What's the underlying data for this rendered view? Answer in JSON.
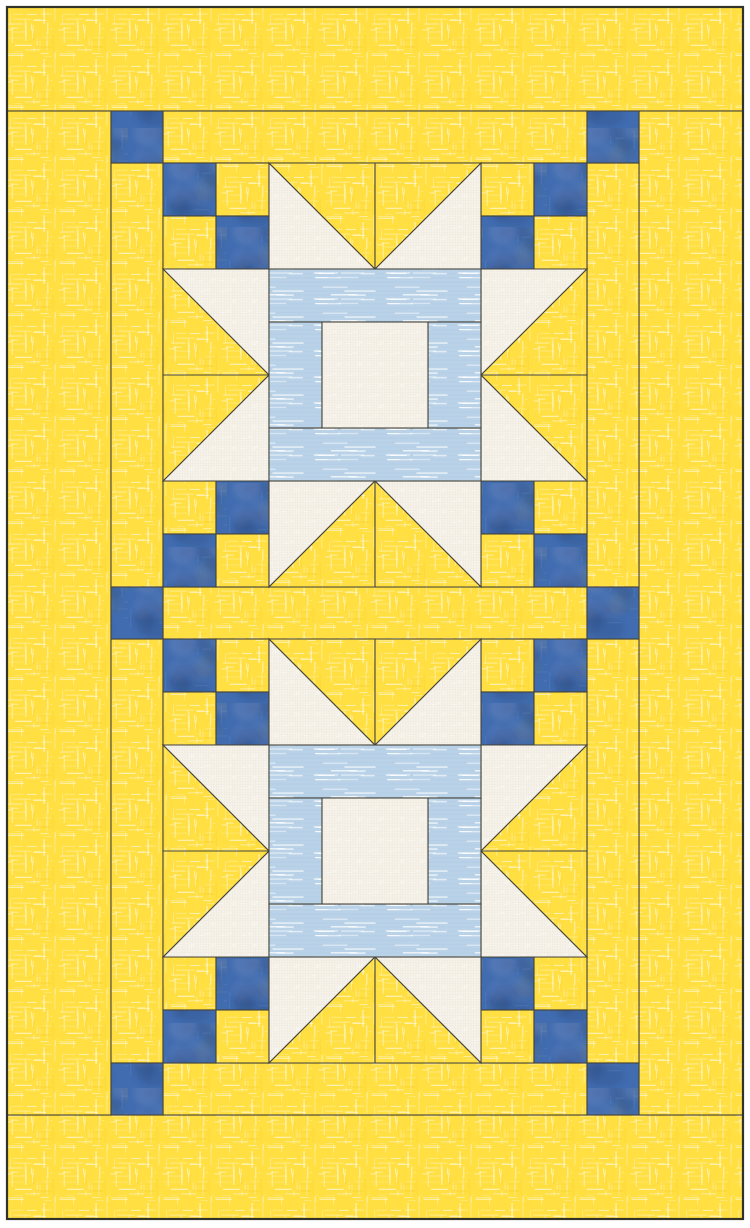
{
  "artwork": {
    "kind": "quilt-pattern-design",
    "canvas": {
      "width": 750,
      "height": 1228
    },
    "palette": {
      "page_background": "#FFFFFF",
      "yellow_fabric": "#FFDF42",
      "yellow_slub": "#FFFFFF",
      "yellow_deep": "#F2C81E",
      "blue_fabric": "#416CB0",
      "blue_dark_mottle": "#2E4E86",
      "blue_light_mottle": "#7B93C2",
      "blue_olive_mottle": "#5E6547",
      "cream_fabric": "#F6F3EB",
      "cream_weave": "#E4DAC8",
      "lightblue_fabric": "#B9D2E8",
      "lightblue_line": "#A9C7E3",
      "seam_line": "#45443A",
      "outer_frame": "#32312A"
    },
    "layout": {
      "margin": 7,
      "outer_rect": [
        7,
        7,
        736,
        1212
      ],
      "borders": [
        {
          "name": "border-top",
          "rect": [
            7,
            7,
            736,
            104
          ]
        },
        {
          "name": "border-bottom",
          "rect": [
            7,
            1115,
            736,
            104
          ]
        },
        {
          "name": "border-left",
          "rect": [
            7,
            111,
            104,
            1004
          ]
        },
        {
          "name": "border-right",
          "rect": [
            639,
            111,
            104,
            1004
          ]
        }
      ],
      "sashing": [
        {
          "name": "sash-row-top",
          "rect": [
            163,
            111,
            424,
            52
          ]
        },
        {
          "name": "sash-row-middle",
          "rect": [
            163,
            587,
            424,
            52
          ]
        },
        {
          "name": "sash-row-bottom",
          "rect": [
            163,
            1063,
            424,
            52
          ]
        },
        {
          "name": "sash-col-left-upper",
          "rect": [
            111,
            163,
            52,
            424
          ]
        },
        {
          "name": "sash-col-right-upper",
          "rect": [
            587,
            163,
            52,
            424
          ]
        },
        {
          "name": "sash-col-left-lower",
          "rect": [
            111,
            639,
            52,
            424
          ]
        },
        {
          "name": "sash-col-right-lower",
          "rect": [
            587,
            639,
            52,
            424
          ]
        }
      ],
      "cornerstone_size": 52,
      "cornerstones": [
        [
          111,
          111
        ],
        [
          587,
          111
        ],
        [
          111,
          587
        ],
        [
          587,
          587
        ],
        [
          111,
          1063
        ],
        [
          587,
          1063
        ]
      ],
      "block_origins": [
        [
          163,
          163
        ],
        [
          163,
          639
        ]
      ]
    },
    "block": {
      "size": 424,
      "unit": 106,
      "patch_square": 53,
      "four_patch_squares": [
        {
          "x": 0,
          "y": 0,
          "f": "blue"
        },
        {
          "x": 53,
          "y": 0,
          "f": "yellow"
        },
        {
          "x": 0,
          "y": 53,
          "f": "yellow"
        },
        {
          "x": 53,
          "y": 53,
          "f": "blue"
        },
        {
          "x": 318,
          "y": 0,
          "f": "yellow"
        },
        {
          "x": 371,
          "y": 0,
          "f": "blue"
        },
        {
          "x": 318,
          "y": 53,
          "f": "blue"
        },
        {
          "x": 371,
          "y": 53,
          "f": "yellow"
        },
        {
          "x": 0,
          "y": 318,
          "f": "yellow"
        },
        {
          "x": 53,
          "y": 318,
          "f": "blue"
        },
        {
          "x": 0,
          "y": 371,
          "f": "blue"
        },
        {
          "x": 53,
          "y": 371,
          "f": "yellow"
        },
        {
          "x": 318,
          "y": 318,
          "f": "blue"
        },
        {
          "x": 371,
          "y": 318,
          "f": "yellow"
        },
        {
          "x": 318,
          "y": 371,
          "f": "yellow"
        },
        {
          "x": 371,
          "y": 371,
          "f": "blue"
        }
      ],
      "star_point_triangles": [
        {
          "pts": [
            [
              106,
              0
            ],
            [
              106,
              106
            ],
            [
              212,
              106
            ]
          ],
          "f": "cream"
        },
        {
          "pts": [
            [
              106,
              0
            ],
            [
              212,
              0
            ],
            [
              212,
              106
            ]
          ],
          "f": "yellow"
        },
        {
          "pts": [
            [
              318,
              0
            ],
            [
              318,
              106
            ],
            [
              212,
              106
            ]
          ],
          "f": "cream"
        },
        {
          "pts": [
            [
              212,
              0
            ],
            [
              318,
              0
            ],
            [
              212,
              106
            ]
          ],
          "f": "yellow"
        },
        {
          "pts": [
            [
              0,
              106
            ],
            [
              106,
              106
            ],
            [
              106,
              212
            ]
          ],
          "f": "cream"
        },
        {
          "pts": [
            [
              0,
              106
            ],
            [
              106,
              212
            ],
            [
              0,
              212
            ]
          ],
          "f": "yellow"
        },
        {
          "pts": [
            [
              106,
              212
            ],
            [
              106,
              318
            ],
            [
              0,
              318
            ]
          ],
          "f": "cream"
        },
        {
          "pts": [
            [
              0,
              212
            ],
            [
              106,
              212
            ],
            [
              0,
              318
            ]
          ],
          "f": "yellow"
        },
        {
          "pts": [
            [
              318,
              106
            ],
            [
              424,
              106
            ],
            [
              318,
              212
            ]
          ],
          "f": "cream"
        },
        {
          "pts": [
            [
              424,
              106
            ],
            [
              424,
              212
            ],
            [
              318,
              212
            ]
          ],
          "f": "yellow"
        },
        {
          "pts": [
            [
              318,
              212
            ],
            [
              318,
              318
            ],
            [
              424,
              318
            ]
          ],
          "f": "cream"
        },
        {
          "pts": [
            [
              318,
              212
            ],
            [
              424,
              212
            ],
            [
              424,
              318
            ]
          ],
          "f": "yellow"
        },
        {
          "pts": [
            [
              106,
              318
            ],
            [
              212,
              318
            ],
            [
              106,
              424
            ]
          ],
          "f": "cream"
        },
        {
          "pts": [
            [
              212,
              318
            ],
            [
              212,
              424
            ],
            [
              106,
              424
            ]
          ],
          "f": "yellow"
        },
        {
          "pts": [
            [
              212,
              318
            ],
            [
              318,
              318
            ],
            [
              318,
              424
            ]
          ],
          "f": "cream"
        },
        {
          "pts": [
            [
              212,
              318
            ],
            [
              318,
              424
            ],
            [
              212,
              424
            ]
          ],
          "f": "yellow"
        }
      ],
      "center_pieces": [
        {
          "x": 106,
          "y": 106,
          "w": 212,
          "h": 53,
          "f": "lightblue"
        },
        {
          "x": 106,
          "y": 265,
          "w": 212,
          "h": 53,
          "f": "lightblue"
        },
        {
          "x": 106,
          "y": 159,
          "w": 53,
          "h": 106,
          "f": "lightblue"
        },
        {
          "x": 265,
          "y": 159,
          "w": 53,
          "h": 106,
          "f": "lightblue"
        },
        {
          "x": 159,
          "y": 159,
          "w": 106,
          "h": 106,
          "f": "cream"
        }
      ]
    }
  }
}
